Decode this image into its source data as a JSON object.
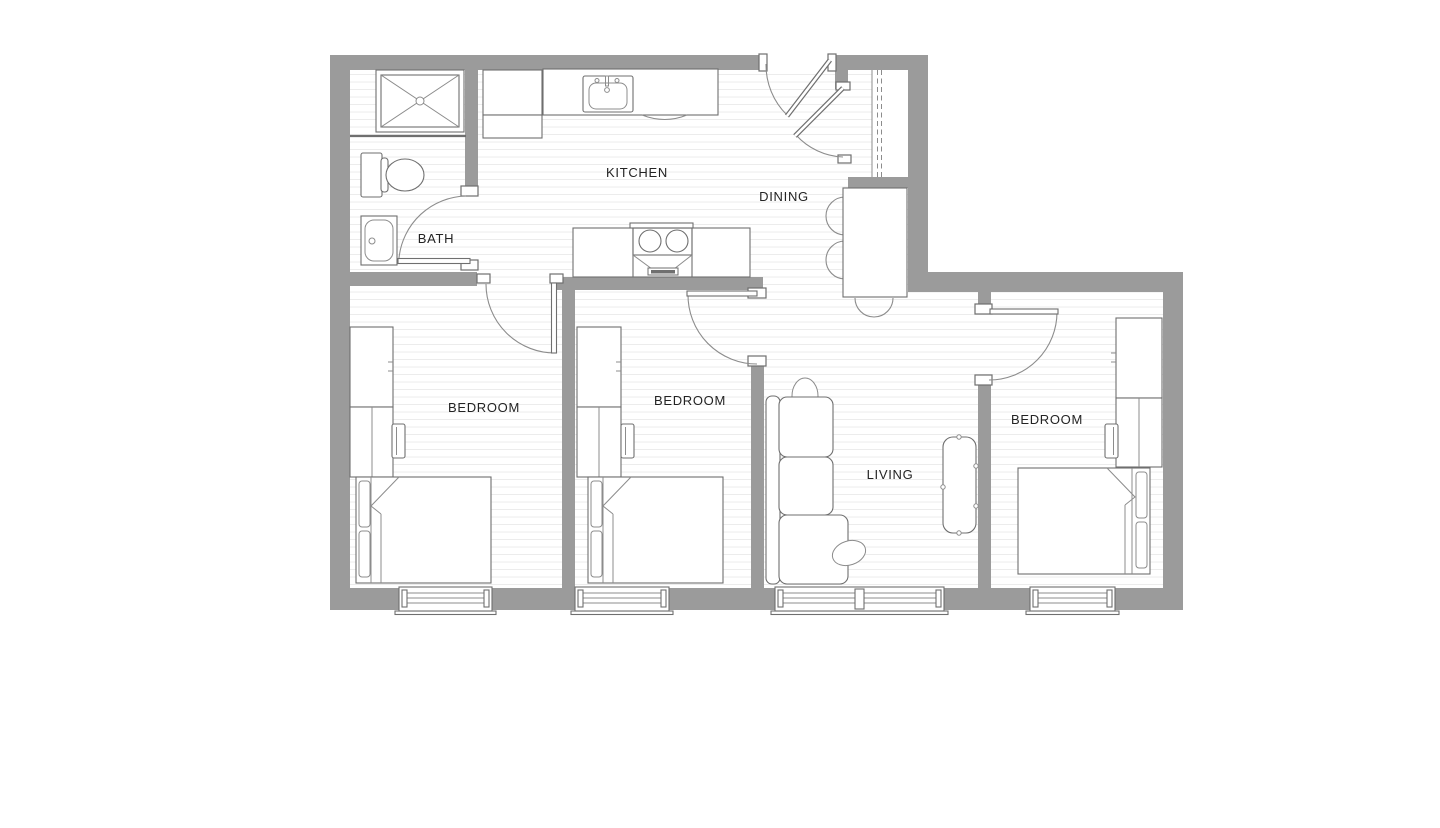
{
  "colors": {
    "wall": "#9b9b9b",
    "line": "#6f6f6f",
    "softline": "#8c8c8c",
    "stripe": "#ebebeb",
    "labelink": "#232323",
    "background": "#ffffff"
  },
  "rooms": [
    {
      "id": "kitchen",
      "label": "KITCHEN"
    },
    {
      "id": "dining",
      "label": "DINING"
    },
    {
      "id": "bath",
      "label": "BATH"
    },
    {
      "id": "bedroom-1",
      "label": "BEDROOM"
    },
    {
      "id": "bedroom-2",
      "label": "BEDROOM"
    },
    {
      "id": "living",
      "label": "LIVING"
    },
    {
      "id": "bedroom-3",
      "label": "BEDROOM"
    }
  ]
}
